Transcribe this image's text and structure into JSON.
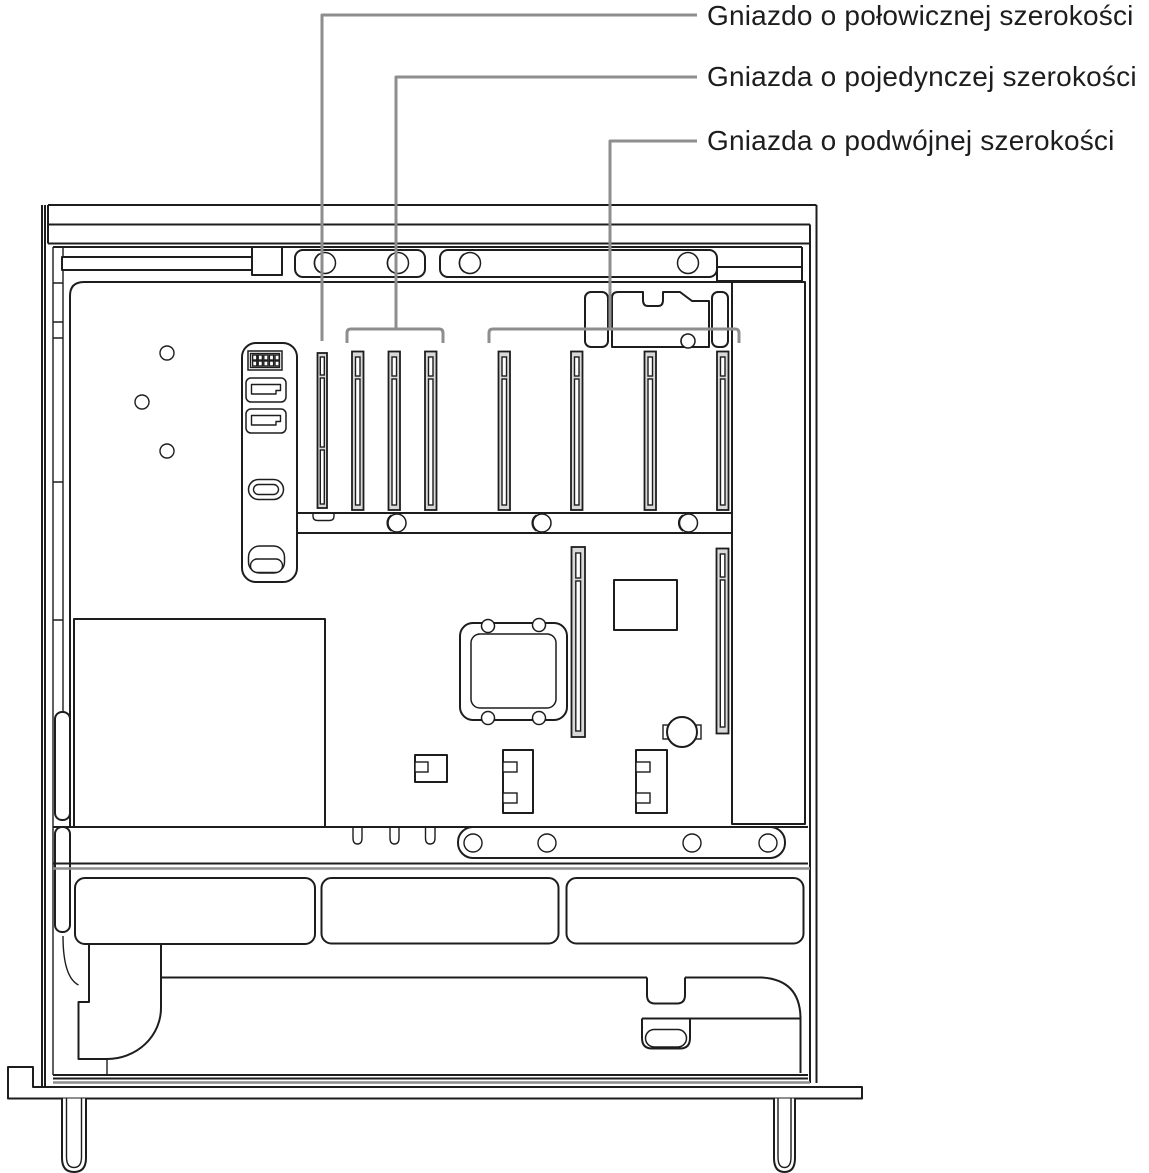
{
  "diagram": {
    "background": "#ffffff",
    "ink_color": "#1d1d1e",
    "callout_color": "#8e8e8e",
    "text_color": "#1d1d1f",
    "slot_fill": "#d9d9d9",
    "callouts": [
      {
        "label": "Gniazdo o połowicznej szerokości",
        "target": "half-width-slot"
      },
      {
        "label": "Gniazda o pojedynczej szerokości",
        "target": "single-width-slots"
      },
      {
        "label": "Gniazda o podwójnej szerokości",
        "target": "double-width-slots"
      }
    ]
  }
}
